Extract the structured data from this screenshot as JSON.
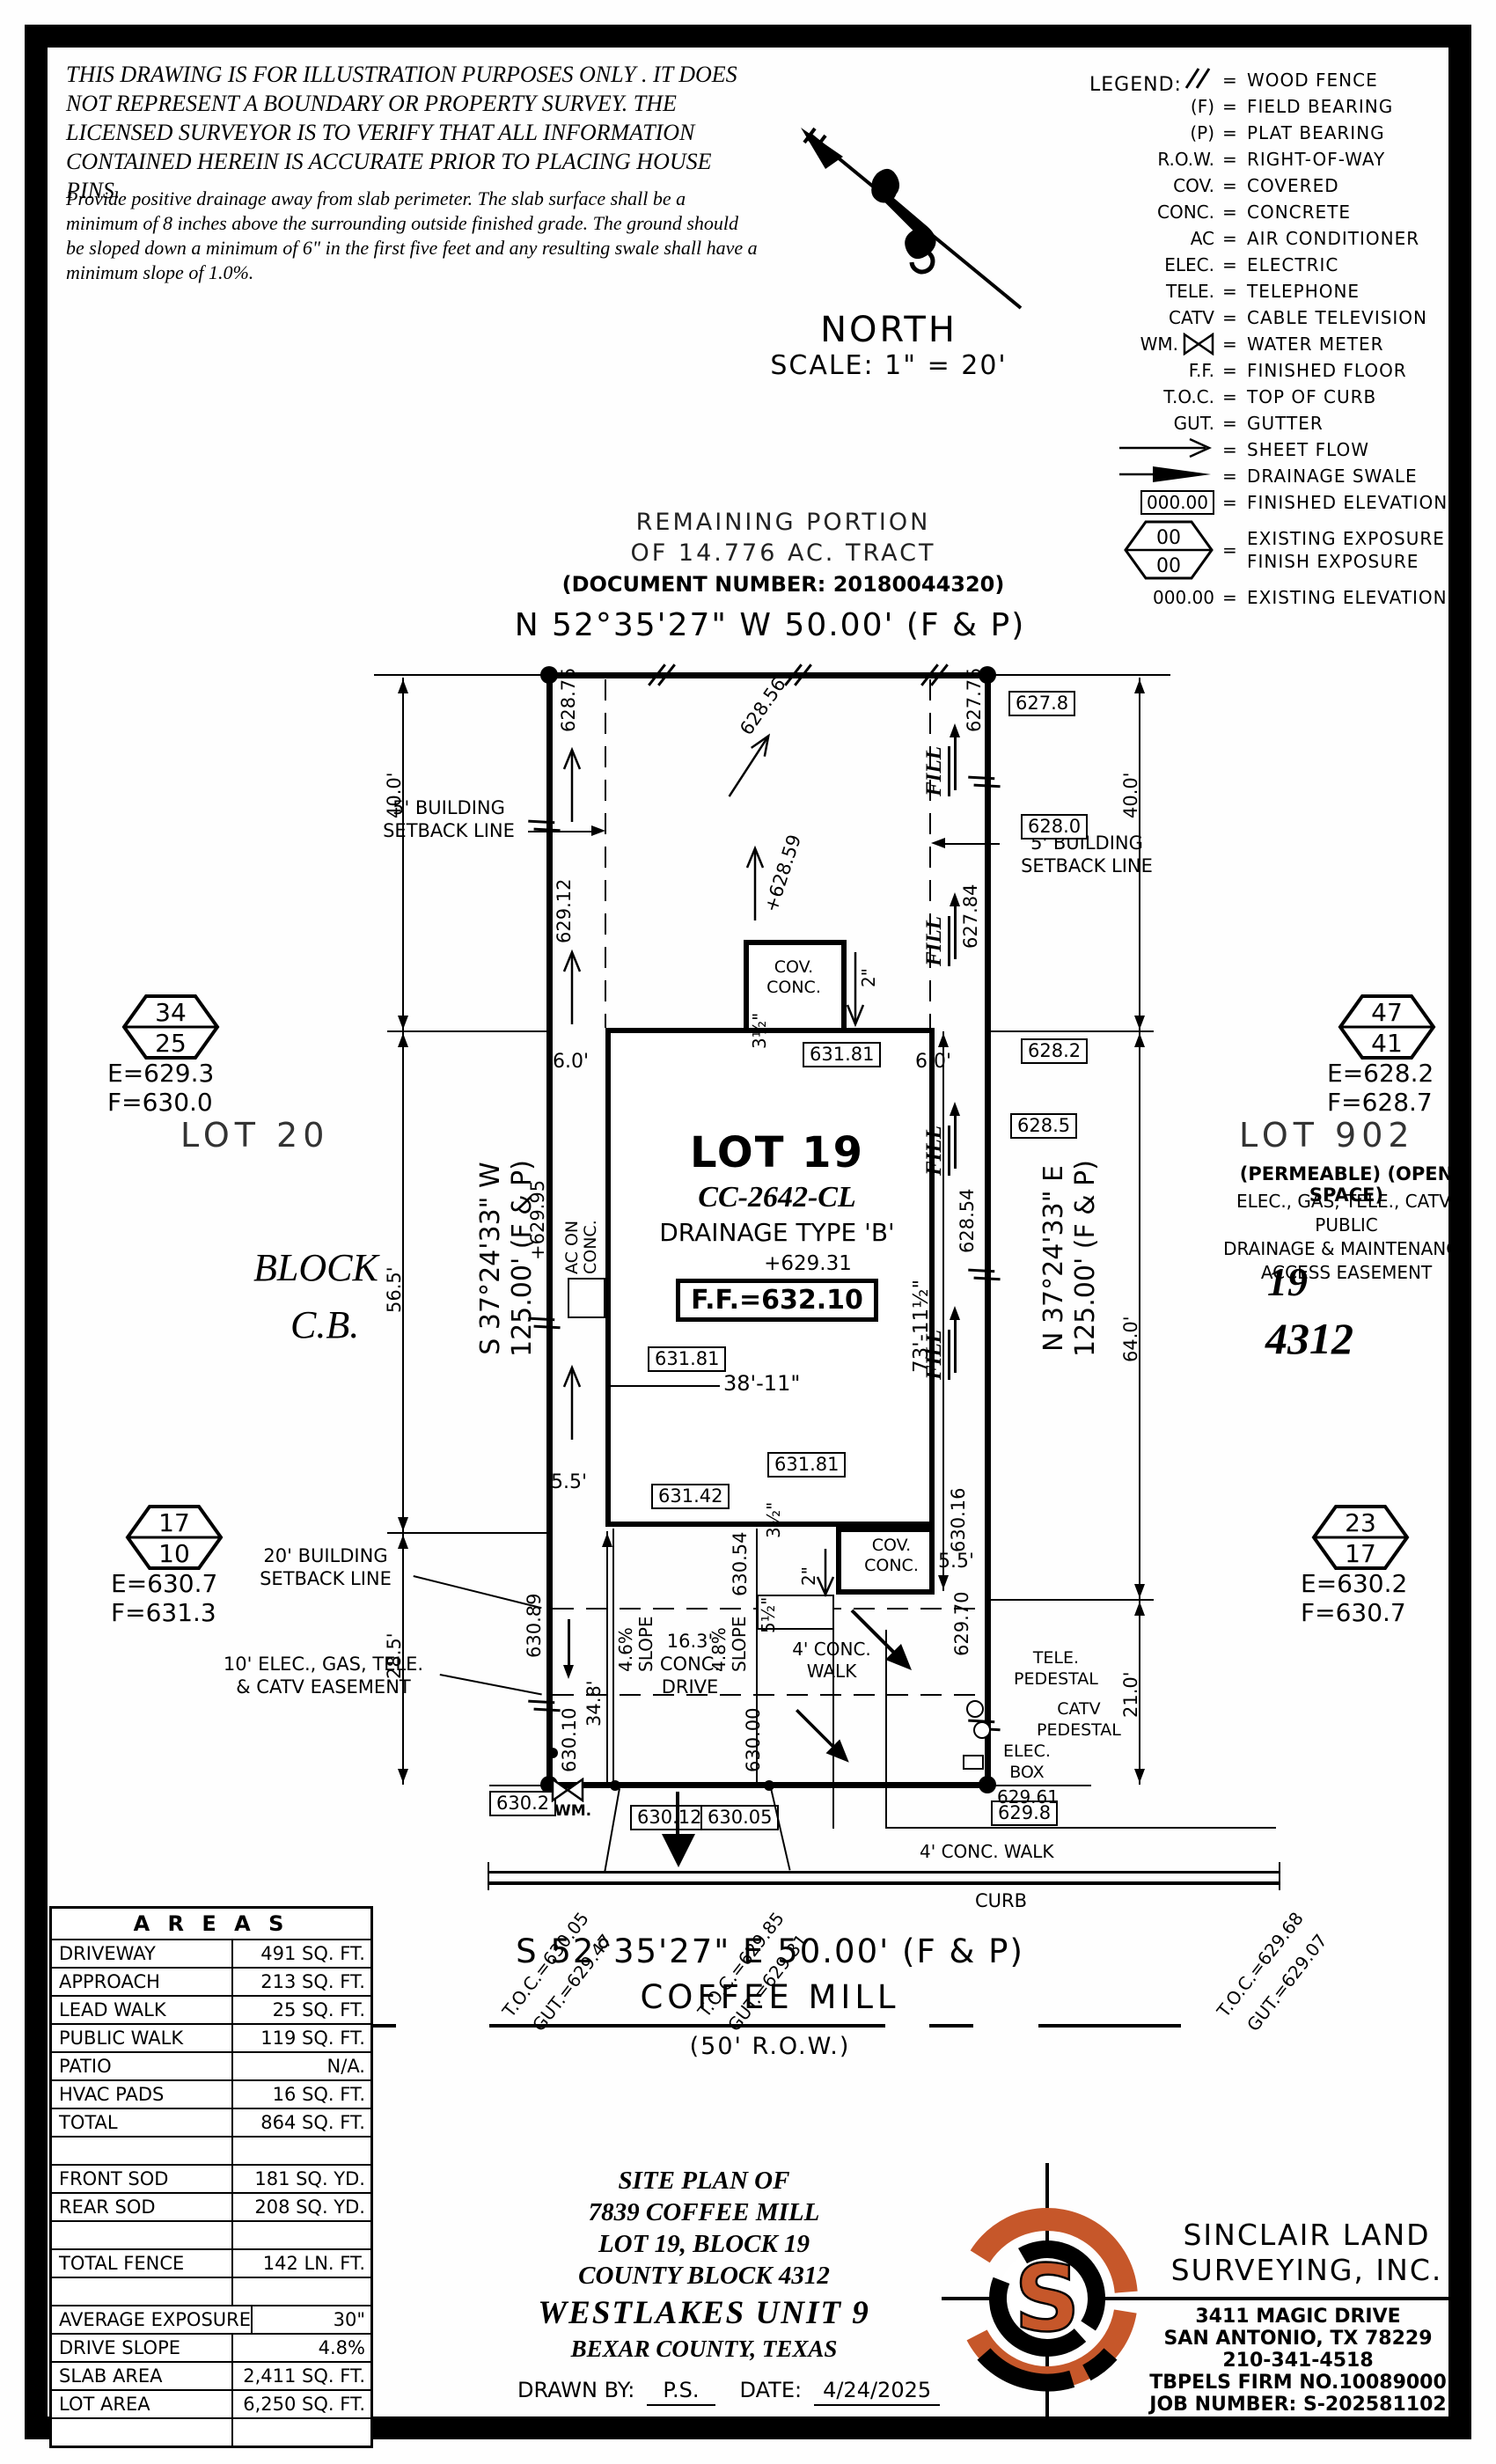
{
  "disclaimer": {
    "para": "THIS DRAWING IS FOR ILLUSTRATION PURPOSES ONLY . IT DOES NOT REPRESENT A BOUNDARY OR PROPERTY SURVEY. THE LICENSED SURVEYOR IS TO VERIFY THAT ALL INFORMATION CONTAINED HEREIN IS ACCURATE PRIOR TO PLACING HOUSE PINS.",
    "note": "Provide positive drainage away from slab perimeter. The slab surface shall be a minimum of 8 inches above the surrounding outside finished grade. The ground should be sloped down a minimum of 6\" in the first five feet and any resulting swale shall have a minimum slope of 1.0%."
  },
  "north": {
    "label": "NORTH",
    "scale": "SCALE: 1\" = 20'"
  },
  "legend": {
    "title": "LEGEND:",
    "eq": "=",
    "hex_top": "00",
    "hex_bottom": "00",
    "rows": [
      {
        "sym": "",
        "desc": "WOOD FENCE"
      },
      {
        "sym": "(F)",
        "desc": "FIELD BEARING"
      },
      {
        "sym": "(P)",
        "desc": "PLAT BEARING"
      },
      {
        "sym": "R.O.W.",
        "desc": "RIGHT-OF-WAY"
      },
      {
        "sym": "COV.",
        "desc": "COVERED"
      },
      {
        "sym": "CONC.",
        "desc": "CONCRETE"
      },
      {
        "sym": "AC",
        "desc": "AIR CONDITIONER"
      },
      {
        "sym": "ELEC.",
        "desc": "ELECTRIC"
      },
      {
        "sym": "TELE.",
        "desc": "TELEPHONE"
      },
      {
        "sym": "CATV",
        "desc": "CABLE TELEVISION"
      },
      {
        "sym": "WM.",
        "desc": "WATER METER"
      },
      {
        "sym": "F.F.",
        "desc": "FINISHED FLOOR"
      },
      {
        "sym": "T.O.C.",
        "desc": "TOP OF CURB"
      },
      {
        "sym": "GUT.",
        "desc": "GUTTER"
      },
      {
        "sym": "",
        "desc": "SHEET FLOW"
      },
      {
        "sym": "",
        "desc": "DRAINAGE SWALE"
      },
      {
        "sym": "000.00",
        "desc": "FINISHED ELEVATION"
      },
      {
        "sym": "",
        "desc": "EXISTING EXPOSURE",
        "desc2": "FINISH EXPOSURE"
      },
      {
        "sym": "000.00",
        "desc": "EXISTING ELEVATION"
      }
    ]
  },
  "tract": {
    "l1": "REMAINING PORTION",
    "l2": "OF 14.776 AC. TRACT",
    "doc": "(DOCUMENT NUMBER: 20180044320)"
  },
  "bearings": {
    "top": "N 52°35'27\" W 50.00' (F & P)",
    "bottom": "S 52°35'27\" E 50.00' (F & P)",
    "west1": "S 37°24'33\" W",
    "west2": "125.00' (F & P)",
    "east1": "N 37°24'33\" E",
    "east2": "125.00' (F & P)"
  },
  "street": {
    "name": "COFFEE MILL",
    "row": "(50' R.O.W.)",
    "curb": "CURB",
    "walk": "4' CONC. WALK"
  },
  "toc": [
    {
      "t": "T.O.C.=630.05",
      "g": "GUT.=629.47"
    },
    {
      "t": "T.O.C.=629.85",
      "g": "GUT.=629.31"
    },
    {
      "t": "T.O.C.=629.68",
      "g": "GUT.=629.07"
    }
  ],
  "lot": {
    "name": "LOT 19",
    "plan": "CC-2642-CL",
    "drainage": "DRAINAGE TYPE 'B'",
    "pad": "+629.31",
    "ff": "F.F.=632.10",
    "lot20": "LOT 20",
    "block": "BLOCK",
    "cb": "C.B.",
    "lot902": "LOT 902",
    "permeable": "(PERMEABLE) (OPEN SPACE)",
    "eas1": "ELEC., GAS, TELE., CATV, PUBLIC",
    "eas2": "DRAINAGE & MAINTENANCE",
    "eas3": "ACCESS EASEMENT",
    "n19": "19",
    "n4312": "4312"
  },
  "exposure": {
    "h1t": "34",
    "h1b": "25",
    "h1e": "E=629.3",
    "h1f": "F=630.0",
    "h2t": "47",
    "h2b": "41",
    "h2e": "E=628.2",
    "h2f": "F=628.7",
    "h3t": "17",
    "h3b": "10",
    "h3e": "E=630.7",
    "h3f": "F=631.3",
    "h4t": "23",
    "h4b": "17",
    "h4e": "E=630.2",
    "h4f": "F=630.7"
  },
  "setbacks": {
    "s5a": "5' BUILDING",
    "s5b": "SETBACK LINE",
    "s20a": "20' BUILDING",
    "s20b": "SETBACK LINE",
    "e10a": "10' ELEC., GAS, TELE.",
    "e10b": "& CATV EASEMENT"
  },
  "elev": {
    "b627_8": "627.8",
    "b628_0": "628.0",
    "b628_2": "628.2",
    "b628_5": "628.5",
    "b631_81": "631.81",
    "b631_42": "631.42",
    "b630_2": "630.2",
    "b630_12": "630.12",
    "b630_05": "630.05",
    "b629_8": "629.8",
    "w1": "628.75",
    "w2": "629.12",
    "w3": "+629.95",
    "w4": "630.89",
    "w5": "630.10",
    "e1": "627.75",
    "e2": "627.84",
    "e3": "628.54",
    "e4": "630.16",
    "e5": "629.70",
    "e6": "630.00",
    "e7": "630.54",
    "flow1": "628.56",
    "flow2": "+628.59",
    "corner": "629.61"
  },
  "dims": {
    "d40": "40.0'",
    "d56": "56.5'",
    "d28": "28.5'",
    "d64": "64.0'",
    "d21": "21.0'",
    "d6": "6.0'",
    "d55": "5.5'",
    "d73": "73'-11½\"",
    "d38": "38'-11\"",
    "d34": "34.8'",
    "d2": "2\"",
    "d35": "3½\"",
    "d5h": "5½\"",
    "slope46": "4.6%",
    "slope48": "4.8%",
    "slope": "SLOPE",
    "drv1": "16.3'",
    "drv2": "CONC.",
    "drv3": "DRIVE"
  },
  "site": {
    "fill": "FILL",
    "cov": "COV.",
    "conc": "CONC.",
    "ac1": "AC ON",
    "ac2": "CONC.",
    "wm": "WM.",
    "tele": "TELE.",
    "ped": "PEDESTAL",
    "catv": "CATV",
    "elec": "ELEC.",
    "box": "BOX",
    "walk1": "4' CONC.",
    "walk2": "WALK"
  },
  "areas": {
    "title": "A R E A S",
    "rows": [
      {
        "label": "DRIVEWAY",
        "value": "491 SQ. FT."
      },
      {
        "label": "APPROACH",
        "value": "213 SQ. FT."
      },
      {
        "label": "LEAD WALK",
        "value": "25 SQ. FT."
      },
      {
        "label": "PUBLIC WALK",
        "value": "119 SQ. FT."
      },
      {
        "label": "PATIO",
        "value": "N/A."
      },
      {
        "label": "HVAC PADS",
        "value": "16 SQ. FT."
      },
      {
        "label": "TOTAL",
        "value": "864 SQ. FT."
      },
      {
        "label": "",
        "value": ""
      },
      {
        "label": "FRONT SOD",
        "value": "181 SQ. YD."
      },
      {
        "label": "REAR SOD",
        "value": "208 SQ. YD."
      },
      {
        "label": "",
        "value": ""
      },
      {
        "label": "TOTAL FENCE",
        "value": "142 LN. FT."
      },
      {
        "label": "",
        "value": ""
      },
      {
        "label": "AVERAGE EXPOSURE",
        "value": "30\""
      },
      {
        "label": "DRIVE SLOPE",
        "value": "4.8%"
      },
      {
        "label": "SLAB AREA",
        "value": "2,411 SQ. FT."
      },
      {
        "label": "LOT AREA",
        "value": "6,250 SQ. FT."
      },
      {
        "label": "",
        "value": ""
      }
    ]
  },
  "titleblock": {
    "l1": "SITE PLAN OF",
    "l2": "7839 COFFEE MILL",
    "l3": "LOT 19, BLOCK 19",
    "l4": "COUNTY BLOCK 4312",
    "l5": "WESTLAKES UNIT 9",
    "l6": "BEXAR COUNTY, TEXAS",
    "drawn": "DRAWN BY:",
    "drawn_val": "P.S.",
    "date": "DATE:",
    "date_val": "4/24/2025"
  },
  "firm": {
    "n1": "SINCLAIR LAND",
    "n2": "SURVEYING, INC.",
    "a1": "3411 MAGIC DRIVE",
    "a2": "SAN ANTONIO, TX 78229",
    "a3": "210-341-4518",
    "a4": "TBPELS FIRM NO.10089000",
    "a5": "JOB NUMBER: S-202581102",
    "s": "S"
  },
  "colors": {
    "accent": "#c6572a"
  }
}
